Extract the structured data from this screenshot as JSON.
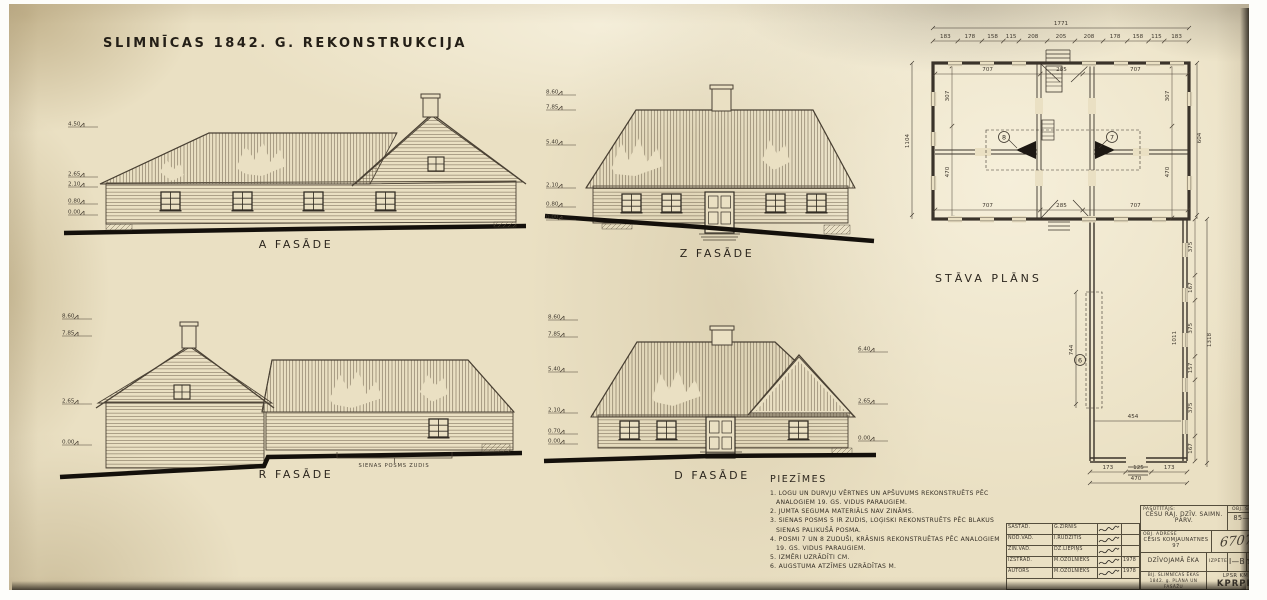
{
  "sheet": {
    "title": "SLIMNĪCAS 1842. G. REKONSTRUKCIJA",
    "paper_color": "#eae0c3",
    "ink_color": "#3a332a"
  },
  "facades": {
    "a": {
      "label": "A FASĀDE",
      "marks": [
        "4.50",
        "2.65",
        "2.10",
        "0.80",
        "0.00"
      ]
    },
    "z": {
      "label": "Z FASĀDE",
      "marks": [
        "8.60",
        "7.85",
        "5.40",
        "2.10",
        "0.80",
        "0.00"
      ]
    },
    "r": {
      "label": "R FASĀDE",
      "marks": [
        "8.60",
        "7.85",
        "2.65",
        "0.00"
      ],
      "annotation": "SIENAS POSMS ZUDIS"
    },
    "d": {
      "label": "D FASĀDE",
      "marks_left": [
        "8.60",
        "7.85",
        "5.40",
        "2.10",
        "0.70",
        "0.00"
      ],
      "marks_right": [
        "6.40",
        "2.65",
        "0.00"
      ]
    }
  },
  "plan": {
    "label": "STĀVA PLĀNS",
    "total_width": "1771",
    "top_segments": [
      "183",
      "178",
      "158",
      "115",
      "208",
      "205",
      "208",
      "178",
      "158",
      "115",
      "183"
    ],
    "total_height_left": "1104",
    "right_height": "604",
    "room_widths_top": [
      "707",
      "285",
      "707"
    ],
    "room_widths_bottom": [
      "707",
      "285",
      "707"
    ],
    "room_heights_left": [
      "307",
      "470"
    ],
    "room_heights_right": [
      "307",
      "470"
    ],
    "stove_numbers": [
      "8",
      "7"
    ],
    "wing": {
      "number": "6",
      "left_dim": "744",
      "inner_dim": "1011",
      "cross_dim": "454",
      "right_segments": [
        "375",
        "167",
        "375",
        "157",
        "375",
        "167"
      ],
      "right_total": "1318",
      "bottom_segments": [
        "173",
        "125",
        "173"
      ],
      "bottom_total": "470"
    }
  },
  "notes": {
    "title": "PIEZĪMES",
    "items": [
      "1. LOGU UN DURVJU VĒRTNES UN APŠUVUMS REKONSTRUĒTS PĒC ANALOGIEM 19. GS. VIDUS PARAUGIEM.",
      "2. JUMTA SEGUMA MATERIĀLS NAV ZINĀMS.",
      "3. SIENAS POSMS 5 IR ZUDIS, LOĢISKI REKONSTRUĒTS PĒC BLAKUS SIENAS PALIKUŠĀ POSMA.",
      "4. POSMI 7 UN 8 ZUDUŠI, KRĀSNIS REKONSTRUĒTAS PĒC ANALOGIEM 19. GS. VIDUS PARAUGIEM.",
      "5. IZMĒRI UZRĀDĪTI CM.",
      "6. AUGSTUMA ATZĪMES UZRĀDĪTAS M."
    ]
  },
  "titleblock": {
    "rows": [
      {
        "role": "SASTĀD.",
        "name": "G.ZIRNIS",
        "date": ""
      },
      {
        "role": "NOD.VAD.",
        "name": "I.RUDZĪTIS",
        "date": ""
      },
      {
        "role": "ZIN.VAD.",
        "name": "DZ.LIEPIŅŠ",
        "date": ""
      },
      {
        "role": "IZSTRĀD.",
        "name": "M.OZOLNIEKS",
        "date": "1978"
      },
      {
        "role": "AUTORS",
        "name": "M.OZOLNIEKS",
        "date": "1978"
      }
    ],
    "client_label": "PASŪTĪTĀJS:",
    "client": "CĒSU RAJ. DZĪV. SAIMN. PĀRV.",
    "code_label": "OBJ. ŠIFRS",
    "code": "85—90",
    "address_label": "OBJ. ADRESE",
    "address": "CĒSIS KOMJAUNATNES 97",
    "inventory": "67071",
    "building": "DZĪVOJAMĀ ĒKA",
    "stage_label": "IZPĒTE",
    "sheet_no": "I—B",
    "scale_label": "MĒROGS",
    "scale": "1:100",
    "subject": "BIJ. SLIMNĪCAS ĒKAS 1842. g. PLĀNA UN FASĀŽU REKONSTRUKCIJA",
    "org1": "LPSR KM",
    "org2": "KPRPK"
  }
}
